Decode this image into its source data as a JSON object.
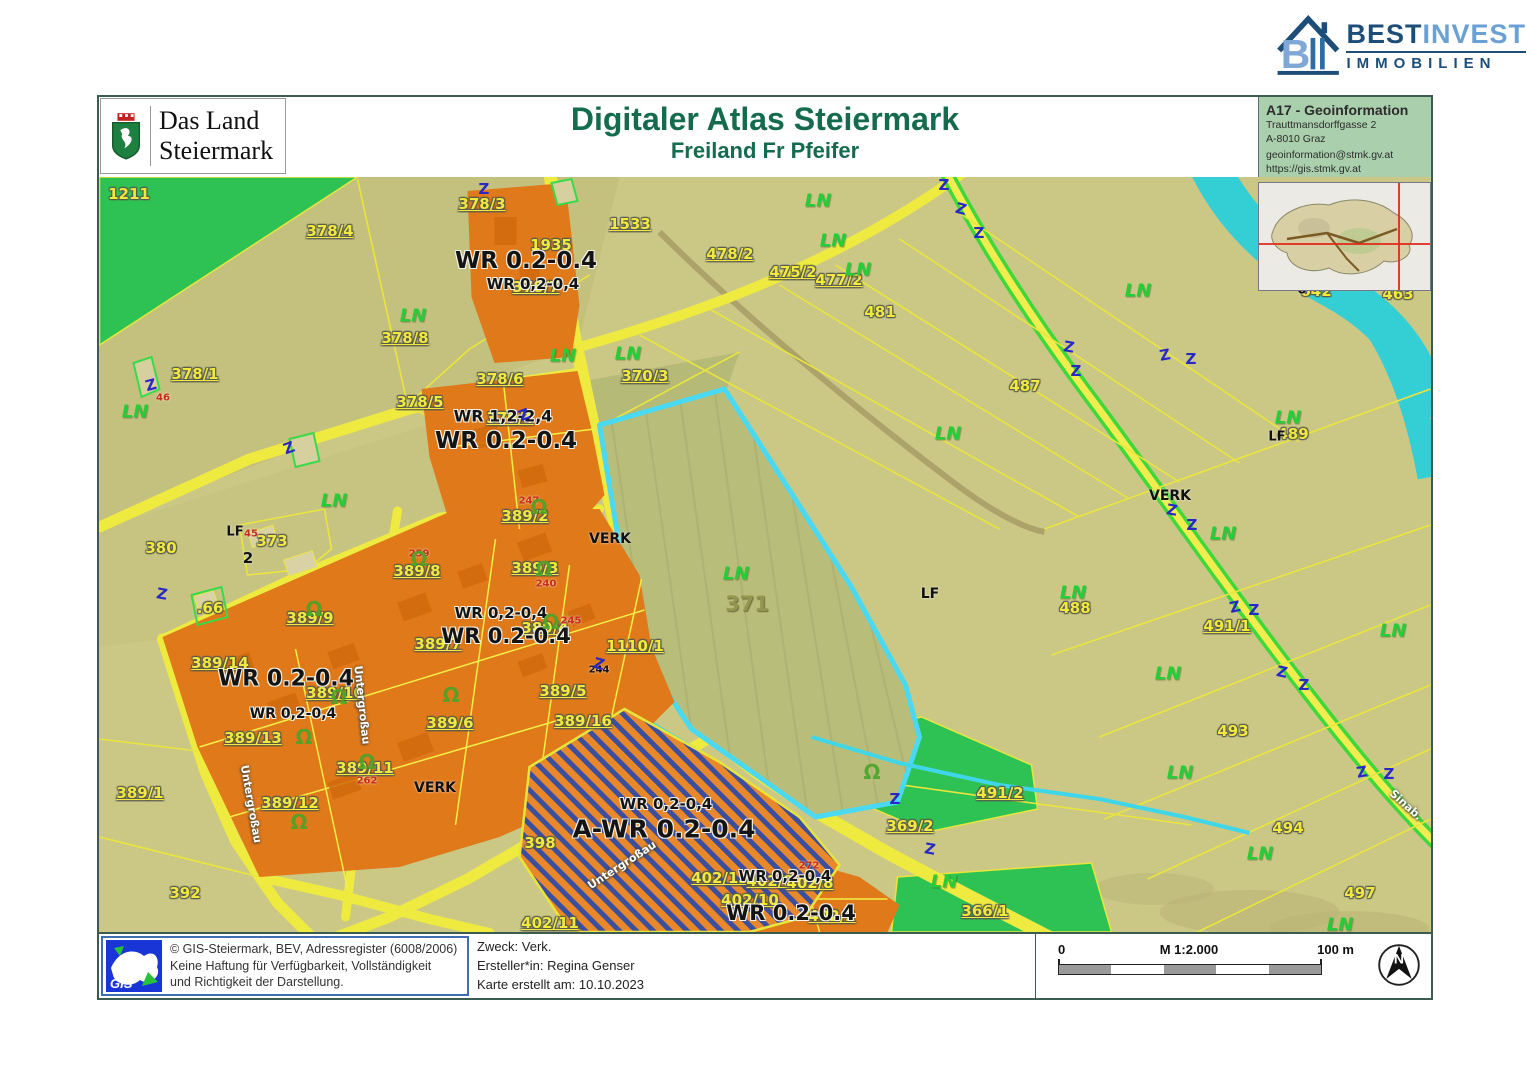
{
  "logo_bestinvest": {
    "name_a": "BEST",
    "name_b": "INVEST",
    "line2": "IMMOBILIEN"
  },
  "land_logo": {
    "line1": "Das Land",
    "line2": "Steiermark"
  },
  "header": {
    "title": "Digitaler Atlas Steiermark",
    "subtitle": "Freiland Fr Pfeifer"
  },
  "info_box": {
    "title": "A17 - Geoinformation",
    "address1": "Trauttmansdorffgasse 2",
    "address2": "A-8010 Graz",
    "email": "geoinformation@stmk.gv.at",
    "url": "https://gis.stmk.gv.at"
  },
  "footer": {
    "gis_logo_text": "GIS",
    "copyright1": "© GIS-Steiermark, BEV, Adressregister (6008/2006)",
    "copyright2": "Keine Haftung für Verfügbarkeit, Vollständigkeit",
    "copyright3": "und Richtigkeit der Darstellung.",
    "purpose": "Zweck: Verk.",
    "creator": "Ersteller*in: Regina Genser",
    "date": "Karte erstellt am: 10.10.2023",
    "scale": {
      "zero": "0",
      "label": "M 1:2.000",
      "hundred": "100 m"
    },
    "north": "N"
  },
  "colors": {
    "accent_green": "#156b4e",
    "zone_orange": "#e0791a",
    "highlight_cyan": "#49d9f2",
    "road_yellow": "#eeea40",
    "water_cyan": "#34cfd4",
    "info_bg": "#a9cfad",
    "hatch_navy": "#3b4f9e"
  },
  "map": {
    "labels": [
      {
        "t": "1211",
        "x": 30,
        "y": 17,
        "c": "lp"
      },
      {
        "t": "378/4",
        "x": 231,
        "y": 54,
        "c": "lp u"
      },
      {
        "t": "378/3",
        "x": 383,
        "y": 27,
        "c": "lp u"
      },
      {
        "t": "1935",
        "x": 452,
        "y": 68,
        "c": "lp"
      },
      {
        "t": "1533",
        "x": 531,
        "y": 47,
        "c": "lp u"
      },
      {
        "t": "478/2",
        "x": 631,
        "y": 77,
        "c": "lp u"
      },
      {
        "t": "475/2",
        "x": 694,
        "y": 95,
        "c": "lp u"
      },
      {
        "t": "477/2",
        "x": 740,
        "y": 103,
        "c": "lp u"
      },
      {
        "t": "481",
        "x": 781,
        "y": 135,
        "c": "lp"
      },
      {
        "t": "487",
        "x": 926,
        "y": 209,
        "c": "lp"
      },
      {
        "t": "642",
        "x": 1217,
        "y": 114,
        "c": "lp"
      },
      {
        "t": "463",
        "x": 1299,
        "y": 117,
        "c": "lp"
      },
      {
        "t": "489",
        "x": 1194,
        "y": 257,
        "c": "lp"
      },
      {
        "t": "378/8",
        "x": 306,
        "y": 161,
        "c": "lp u"
      },
      {
        "t": "378/1",
        "x": 96,
        "y": 197,
        "c": "lp u"
      },
      {
        "t": "378/6",
        "x": 401,
        "y": 202,
        "c": "lp u"
      },
      {
        "t": "378/5",
        "x": 321,
        "y": 225,
        "c": "lp u"
      },
      {
        "t": "370/3",
        "x": 546,
        "y": 199,
        "c": "lp u"
      },
      {
        "t": "379/4",
        "x": 411,
        "y": 241,
        "c": "lp u"
      },
      {
        "t": "378/7",
        "x": 437,
        "y": 110,
        "c": "lp u"
      },
      {
        "t": "380",
        "x": 62,
        "y": 371,
        "c": "lp"
      },
      {
        "t": "373",
        "x": 173,
        "y": 364,
        "c": "lp"
      },
      {
        "t": ".66",
        "x": 111,
        "y": 431,
        "c": "lp"
      },
      {
        "t": "389/2",
        "x": 426,
        "y": 339,
        "c": "lp u"
      },
      {
        "t": "389/8",
        "x": 318,
        "y": 394,
        "c": "lp u"
      },
      {
        "t": "389/3",
        "x": 436,
        "y": 391,
        "c": "lp u"
      },
      {
        "t": "389/9",
        "x": 211,
        "y": 441,
        "c": "lp u"
      },
      {
        "t": "389/4",
        "x": 446,
        "y": 451,
        "c": "lp u"
      },
      {
        "t": "389/7",
        "x": 339,
        "y": 467,
        "c": "lp u"
      },
      {
        "t": "389/14",
        "x": 121,
        "y": 486,
        "c": "lp u"
      },
      {
        "t": "389/10",
        "x": 236,
        "y": 516,
        "c": "lp u"
      },
      {
        "t": "1110/1",
        "x": 536,
        "y": 469,
        "c": "lp u"
      },
      {
        "t": "389/5",
        "x": 464,
        "y": 514,
        "c": "lp u"
      },
      {
        "t": "389/16",
        "x": 484,
        "y": 544,
        "c": "lp u"
      },
      {
        "t": "389/13",
        "x": 154,
        "y": 561,
        "c": "lp u"
      },
      {
        "t": "389/6",
        "x": 351,
        "y": 546,
        "c": "lp u"
      },
      {
        "t": "389/11",
        "x": 266,
        "y": 591,
        "c": "lp u"
      },
      {
        "t": "389/12",
        "x": 191,
        "y": 626,
        "c": "lp u"
      },
      {
        "t": "389/1",
        "x": 41,
        "y": 616,
        "c": "lp u"
      },
      {
        "t": "392",
        "x": 86,
        "y": 716,
        "c": "lp"
      },
      {
        "t": "398",
        "x": 441,
        "y": 666,
        "c": "lp"
      },
      {
        "t": "402/13",
        "x": 621,
        "y": 701,
        "c": "lp u"
      },
      {
        "t": "402/9",
        "x": 671,
        "y": 704,
        "c": "lp u"
      },
      {
        "t": "402/8",
        "x": 711,
        "y": 706,
        "c": "lp u"
      },
      {
        "t": "402/10",
        "x": 651,
        "y": 723,
        "c": "lp u"
      },
      {
        "t": "402/11",
        "x": 451,
        "y": 746,
        "c": "lp u"
      },
      {
        "t": "402/2",
        "x": 733,
        "y": 739,
        "c": "lp u"
      },
      {
        "t": "369/2",
        "x": 811,
        "y": 649,
        "c": "lp u"
      },
      {
        "t": "366/1",
        "x": 886,
        "y": 734,
        "c": "lp u"
      },
      {
        "t": "488",
        "x": 976,
        "y": 431,
        "c": "lp"
      },
      {
        "t": "491/1",
        "x": 1128,
        "y": 449,
        "c": "lp u"
      },
      {
        "t": "491/2",
        "x": 901,
        "y": 616,
        "c": "lp u"
      },
      {
        "t": "493",
        "x": 1134,
        "y": 554,
        "c": "lp"
      },
      {
        "t": "494",
        "x": 1189,
        "y": 651,
        "c": "lp"
      },
      {
        "t": "497",
        "x": 1261,
        "y": 716,
        "c": "lp"
      },
      {
        "t": "WR 0.2-0.4",
        "x": 427,
        "y": 84,
        "c": "lz",
        "s": 23
      },
      {
        "t": "WR 0,2-0,4",
        "x": 434,
        "y": 107,
        "c": "lz",
        "s": 15
      },
      {
        "t": "WR 1,2-2,4",
        "x": 404,
        "y": 239,
        "c": "lz",
        "s": 16
      },
      {
        "t": "WR 0.2-0.4",
        "x": 407,
        "y": 264,
        "c": "lz",
        "s": 23
      },
      {
        "t": "WR 0,2-0,4",
        "x": 402,
        "y": 436,
        "c": "lz",
        "s": 15
      },
      {
        "t": "WR 0.2-0.4",
        "x": 407,
        "y": 459,
        "c": "lz",
        "s": 21
      },
      {
        "t": "WR 0.2-0.4",
        "x": 187,
        "y": 502,
        "c": "lz",
        "s": 22
      },
      {
        "t": "WR 0,2-0,4",
        "x": 194,
        "y": 537,
        "c": "lz",
        "s": 14
      },
      {
        "t": "WR 0,2-0,4",
        "x": 567,
        "y": 627,
        "c": "lz",
        "s": 15
      },
      {
        "t": "A-WR 0.2-0.4",
        "x": 565,
        "y": 652,
        "c": "lz",
        "s": 25
      },
      {
        "t": "WR 0,2-0,4",
        "x": 686,
        "y": 699,
        "c": "lz",
        "s": 15
      },
      {
        "t": "WR 0.2-0.4",
        "x": 692,
        "y": 736,
        "c": "lz",
        "s": 21
      },
      {
        "t": "VERK",
        "x": 511,
        "y": 362,
        "c": "lm-black"
      },
      {
        "t": "VERK",
        "x": 336,
        "y": 611,
        "c": "lm-black"
      },
      {
        "t": "VERK",
        "x": 1071,
        "y": 319,
        "c": "lm-black"
      },
      {
        "t": "LF",
        "x": 136,
        "y": 355,
        "c": "lm-black",
        "s": 13
      },
      {
        "t": "LF",
        "x": 831,
        "y": 417,
        "c": "lm-black"
      },
      {
        "t": "LF",
        "x": 1178,
        "y": 260,
        "c": "lm-black",
        "s": 13
      },
      {
        "t": "ö",
        "x": 1203,
        "y": 113,
        "c": "lm-black",
        "s": 13
      },
      {
        "t": "2",
        "x": 149,
        "y": 381,
        "c": "lm-black",
        "s": 15
      },
      {
        "t": "371",
        "x": 648,
        "y": 427,
        "c": "lm-olive"
      },
      {
        "t": "46",
        "x": 64,
        "y": 221,
        "c": "lm-red"
      },
      {
        "t": "45",
        "x": 152,
        "y": 357,
        "c": "lm-red"
      },
      {
        "t": "247",
        "x": 430,
        "y": 324,
        "c": "lm-red"
      },
      {
        "t": "259",
        "x": 320,
        "y": 377,
        "c": "lm-red"
      },
      {
        "t": "240",
        "x": 447,
        "y": 407,
        "c": "lm-red"
      },
      {
        "t": "245",
        "x": 472,
        "y": 444,
        "c": "lm-red"
      },
      {
        "t": "262",
        "x": 268,
        "y": 604,
        "c": "lm-red"
      },
      {
        "t": "272",
        "x": 710,
        "y": 689,
        "c": "lm-red"
      },
      {
        "t": "244",
        "x": 500,
        "y": 493,
        "c": "lm-black",
        "s": 10
      },
      {
        "t": "LN",
        "x": 36,
        "y": 235,
        "c": "ln"
      },
      {
        "t": "LN",
        "x": 235,
        "y": 324,
        "c": "ln"
      },
      {
        "t": "LN",
        "x": 314,
        "y": 139,
        "c": "ln"
      },
      {
        "t": "LN",
        "x": 464,
        "y": 179,
        "c": "ln"
      },
      {
        "t": "LN",
        "x": 529,
        "y": 177,
        "c": "ln"
      },
      {
        "t": "LN",
        "x": 637,
        "y": 397,
        "c": "ln"
      },
      {
        "t": "LN",
        "x": 719,
        "y": 24,
        "c": "ln"
      },
      {
        "t": "LN",
        "x": 734,
        "y": 64,
        "c": "ln"
      },
      {
        "t": "LN",
        "x": 759,
        "y": 93,
        "c": "ln"
      },
      {
        "t": "LN",
        "x": 849,
        "y": 257,
        "c": "ln"
      },
      {
        "t": "LN",
        "x": 1039,
        "y": 114,
        "c": "ln"
      },
      {
        "t": "LN",
        "x": 1189,
        "y": 241,
        "c": "ln"
      },
      {
        "t": "LN",
        "x": 1124,
        "y": 357,
        "c": "ln"
      },
      {
        "t": "LN",
        "x": 974,
        "y": 416,
        "c": "ln"
      },
      {
        "t": "LN",
        "x": 1294,
        "y": 454,
        "c": "ln"
      },
      {
        "t": "LN",
        "x": 1069,
        "y": 497,
        "c": "ln"
      },
      {
        "t": "LN",
        "x": 1081,
        "y": 596,
        "c": "ln"
      },
      {
        "t": "LN",
        "x": 1161,
        "y": 677,
        "c": "ln"
      },
      {
        "t": "LN",
        "x": 845,
        "y": 705,
        "c": "ln"
      },
      {
        "t": "LN",
        "x": 1241,
        "y": 748,
        "c": "ln"
      },
      {
        "t": "Untergroßau",
        "x": 152,
        "y": 627,
        "c": "lst",
        "r": 80
      },
      {
        "t": "Untergroßau",
        "x": 263,
        "y": 528,
        "c": "lst",
        "r": 84
      },
      {
        "t": "Untergroßau",
        "x": 523,
        "y": 688,
        "c": "lst",
        "r": -33
      },
      {
        "t": "Sinab.",
        "x": 1307,
        "y": 628,
        "c": "lst",
        "r": 42
      },
      {
        "t": "Z",
        "x": 52,
        "y": 208,
        "c": "zmark",
        "r": -15
      },
      {
        "t": "Z",
        "x": 63,
        "y": 417,
        "c": "zmark",
        "r": 10
      },
      {
        "t": "Z",
        "x": 190,
        "y": 271,
        "c": "zmark",
        "r": -20
      },
      {
        "t": "Z",
        "x": 385,
        "y": 12,
        "c": "zmark"
      },
      {
        "t": "Z",
        "x": 845,
        "y": 8,
        "c": "zmark"
      },
      {
        "t": "Z",
        "x": 862,
        "y": 32,
        "c": "zmark",
        "r": 15
      },
      {
        "t": "Z",
        "x": 880,
        "y": 56,
        "c": "zmark"
      },
      {
        "t": "Z",
        "x": 970,
        "y": 170,
        "c": "zmark",
        "r": 10
      },
      {
        "t": "Z",
        "x": 977,
        "y": 194,
        "c": "zmark"
      },
      {
        "t": "Z",
        "x": 1066,
        "y": 178,
        "c": "zmark",
        "r": -10
      },
      {
        "t": "Z",
        "x": 1092,
        "y": 182,
        "c": "zmark"
      },
      {
        "t": "Z",
        "x": 1073,
        "y": 333,
        "c": "zmark",
        "r": 10
      },
      {
        "t": "Z",
        "x": 1093,
        "y": 348,
        "c": "zmark"
      },
      {
        "t": "Z",
        "x": 1136,
        "y": 430,
        "c": "zmark",
        "r": -12
      },
      {
        "t": "Z",
        "x": 1155,
        "y": 433,
        "c": "zmark"
      },
      {
        "t": "Z",
        "x": 1183,
        "y": 495,
        "c": "zmark",
        "r": 12
      },
      {
        "t": "Z",
        "x": 1205,
        "y": 508,
        "c": "zmark"
      },
      {
        "t": "Z",
        "x": 1263,
        "y": 595,
        "c": "zmark",
        "r": -10
      },
      {
        "t": "Z",
        "x": 1290,
        "y": 597,
        "c": "zmark"
      },
      {
        "t": "Z",
        "x": 796,
        "y": 622,
        "c": "zmark"
      },
      {
        "t": "Z",
        "x": 831,
        "y": 672,
        "c": "zmark",
        "r": 10
      },
      {
        "t": "Z",
        "x": 425,
        "y": 238,
        "c": "zmark",
        "r": -20
      },
      {
        "t": "Z",
        "x": 500,
        "y": 487,
        "c": "zmark",
        "r": 15
      },
      {
        "t": "Ω",
        "x": 440,
        "y": 330,
        "c": "om"
      },
      {
        "t": "Ω",
        "x": 320,
        "y": 382,
        "c": "om"
      },
      {
        "t": "Ω",
        "x": 445,
        "y": 392,
        "c": "om"
      },
      {
        "t": "Ω",
        "x": 215,
        "y": 432,
        "c": "om"
      },
      {
        "t": "Ω",
        "x": 452,
        "y": 445,
        "c": "om"
      },
      {
        "t": "Ω",
        "x": 240,
        "y": 520,
        "c": "om"
      },
      {
        "t": "Ω",
        "x": 205,
        "y": 560,
        "c": "om"
      },
      {
        "t": "Ω",
        "x": 268,
        "y": 585,
        "c": "om"
      },
      {
        "t": "Ω",
        "x": 200,
        "y": 645,
        "c": "om"
      },
      {
        "t": "Ω",
        "x": 352,
        "y": 518,
        "c": "om"
      },
      {
        "t": "Ω",
        "x": 773,
        "y": 595,
        "c": "om"
      }
    ]
  }
}
